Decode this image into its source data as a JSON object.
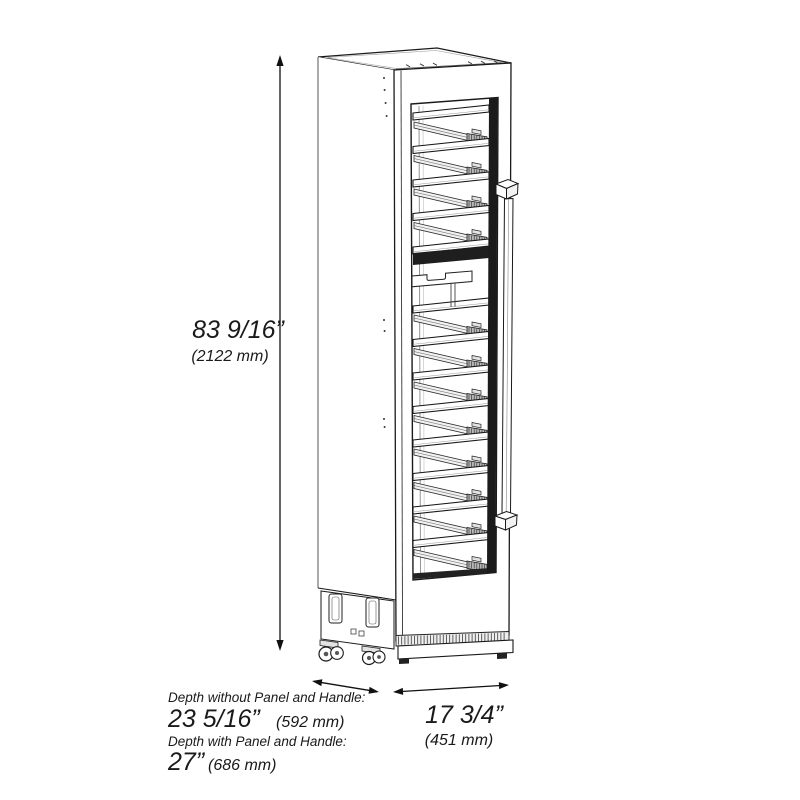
{
  "meta": {
    "type": "product-dimension-diagram",
    "product": "Tall slim wine cooler, isometric line drawing with glass door, wine racks and vertical bar handle"
  },
  "dimensions": {
    "height": {
      "imperial": "83 9/16”",
      "metric": "(2122 mm)"
    },
    "width": {
      "imperial": "17 3/4”",
      "metric": "(451 mm)"
    },
    "depth_without_panel": {
      "label": "Depth without Panel and Handle:",
      "imperial": "23 5/16”",
      "metric": "(592 mm)"
    },
    "depth_with_panel": {
      "label": "Depth with Panel and Handle:",
      "imperial": "27”",
      "metric": "(686 mm)"
    }
  },
  "racks": {
    "upper_count": 5,
    "lower_count": 8
  },
  "colors": {
    "line": "#1a1a1a",
    "line_soft": "#6f6f6f",
    "fill": "#ffffff",
    "band": "#1e1e1e",
    "shelf_shade": "#f1f1f1",
    "bracket": "#b9b9b9"
  }
}
